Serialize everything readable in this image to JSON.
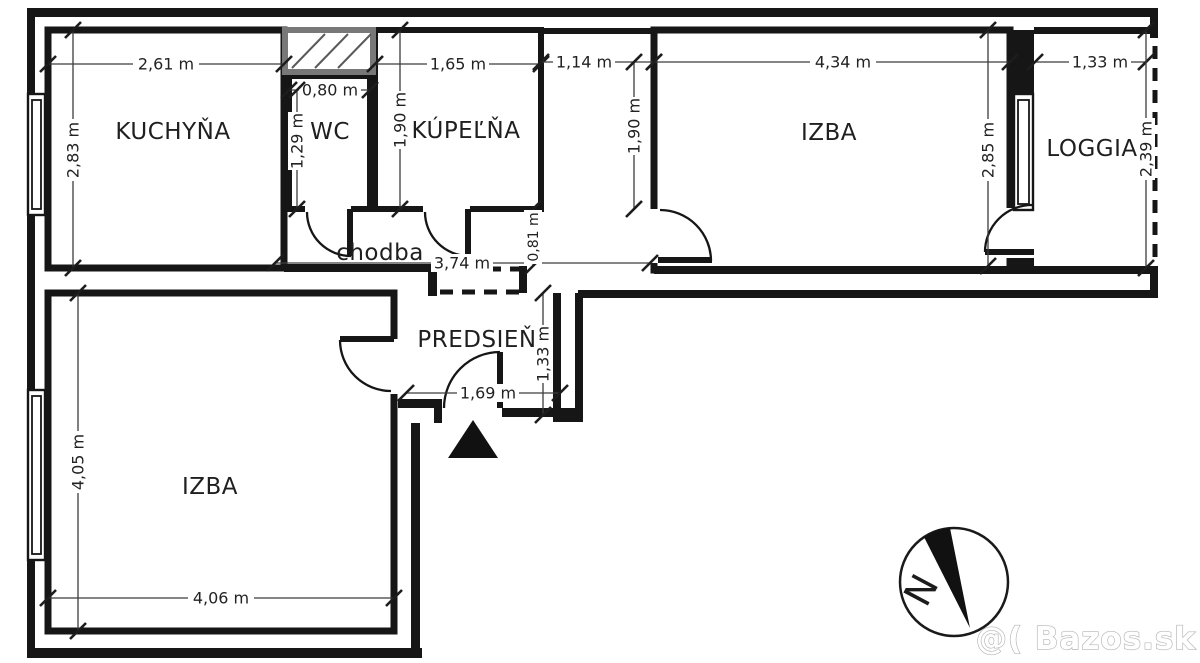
{
  "plan": {
    "type": "apartment-floor-plan",
    "rooms": [
      {
        "key": "kuchyna",
        "label": "KUCHYŇA"
      },
      {
        "key": "wc",
        "label": "WC"
      },
      {
        "key": "kupelna",
        "label": "KÚPEĽŇA"
      },
      {
        "key": "izba_horna",
        "label": "IZBA"
      },
      {
        "key": "loggia",
        "label": "LOGGIA"
      },
      {
        "key": "chodba",
        "label": "chodba"
      },
      {
        "key": "predsien",
        "label": "PREDSIEŇ"
      },
      {
        "key": "izba_dolna",
        "label": "IZBA"
      }
    ],
    "dimensions": [
      {
        "key": "kuchyna-width",
        "label": "2,61 m"
      },
      {
        "key": "kuchyna-height",
        "label": "2,83 m"
      },
      {
        "key": "wc-width",
        "label": "0,80 m"
      },
      {
        "key": "wc-height",
        "label": "1,29 m"
      },
      {
        "key": "kupelna-width",
        "label": "1,65 m"
      },
      {
        "key": "kupelna-height",
        "label": "1,90 m"
      },
      {
        "key": "koridor-width",
        "label": "1,14 m"
      },
      {
        "key": "koridor-height",
        "label": "1,90 m"
      },
      {
        "key": "izba-horna-width",
        "label": "4,34 m"
      },
      {
        "key": "izba-horna-height",
        "label": "2,85 m"
      },
      {
        "key": "loggia-width",
        "label": "1,33 m"
      },
      {
        "key": "loggia-height",
        "label": "2,39 m"
      },
      {
        "key": "chodba-length",
        "label": "3,74 m"
      },
      {
        "key": "chodba-width",
        "label": "0,81 m"
      },
      {
        "key": "predsien-width",
        "label": "1,69 m"
      },
      {
        "key": "predsien-height",
        "label": "1,33 m"
      },
      {
        "key": "izba-dolna-height",
        "label": "4,05 m"
      },
      {
        "key": "izba-dolna-width",
        "label": "4,06 m"
      }
    ],
    "compass": {
      "north_label": "N"
    },
    "watermark": {
      "text": "@( Bazos.sk"
    }
  }
}
